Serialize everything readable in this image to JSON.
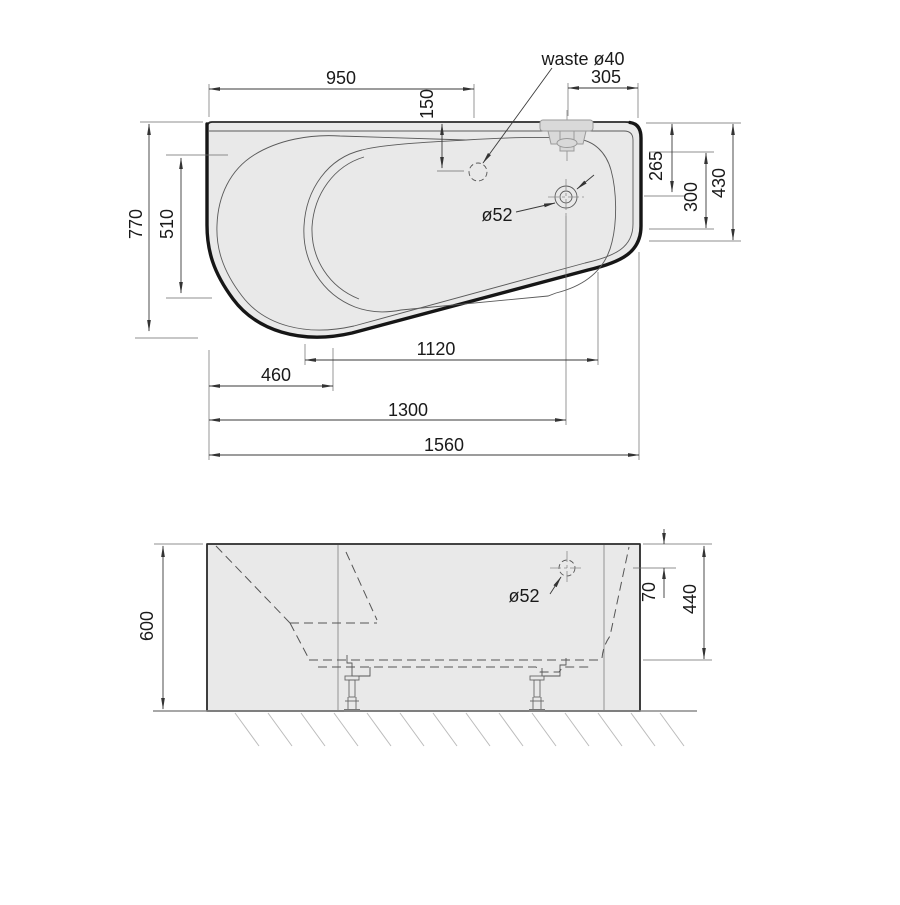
{
  "drawing": {
    "title": "bathtub-technical-drawing",
    "colors": {
      "body_fill": "#e9e9e9",
      "outline": "#161616",
      "thin_line": "#5a5a5a",
      "background": "#ffffff"
    },
    "top_view": {
      "labels": {
        "waste_callout": "waste ø40",
        "drain_callout": "ø52",
        "width_to_waste": "950",
        "right_offset": "305",
        "waste_from_edge": "150",
        "overall_depth": "770",
        "inner_depth": "510",
        "right_265": "265",
        "right_300": "300",
        "right_430": "430",
        "bottom_1120": "1120",
        "bottom_460": "460",
        "bottom_1300": "1300",
        "overall_length": "1560"
      }
    },
    "front_view": {
      "labels": {
        "overall_height": "600",
        "overflow_callout": "ø52",
        "overflow_from_top": "70",
        "inner_height": "440"
      }
    }
  }
}
